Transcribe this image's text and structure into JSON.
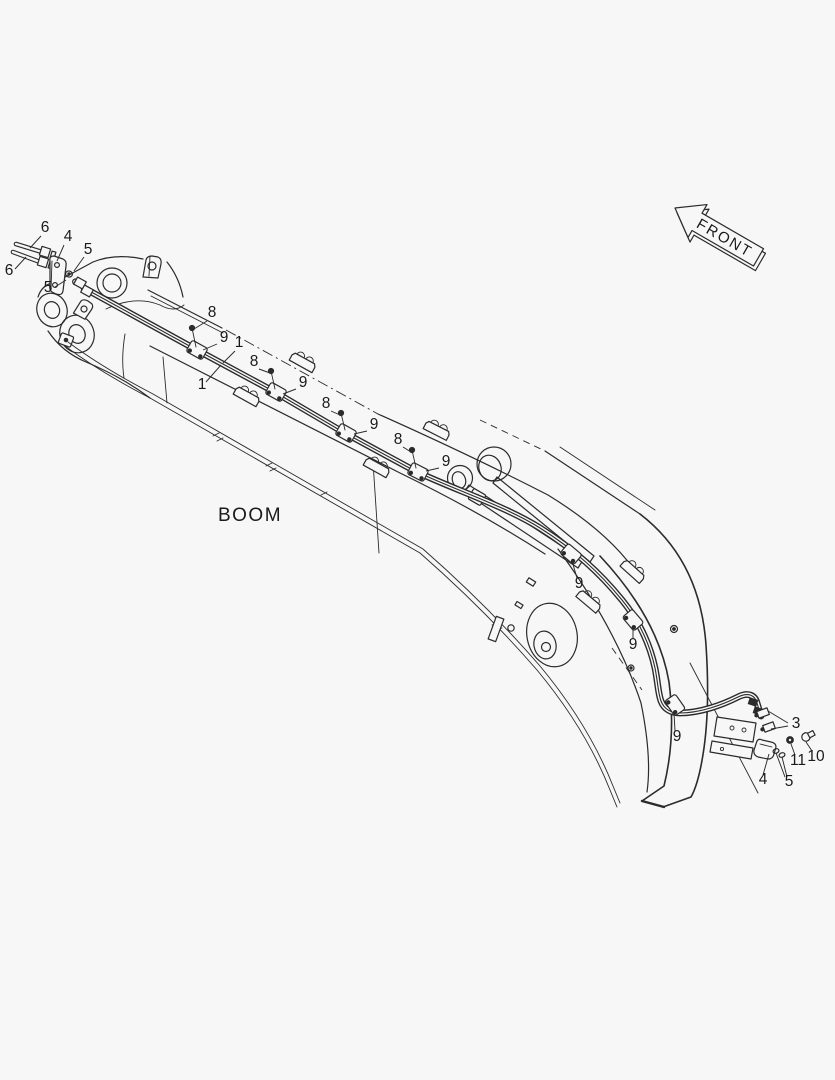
{
  "figure": {
    "type": "parts-diagram",
    "boom_label": "BOOM",
    "front_label": "FRONT"
  },
  "colors": {
    "background": "#f7f7f7",
    "line": "#2b2b2b",
    "text": "#1a1a1a"
  },
  "boom_label_pos": {
    "x": 250,
    "y": 521
  },
  "callouts": [
    {
      "t": "6",
      "x": 45,
      "y": 232,
      "l": [
        [
          41,
          236,
          30,
          248
        ]
      ]
    },
    {
      "t": "4",
      "x": 68,
      "y": 241,
      "l": [
        [
          64,
          245,
          57,
          261
        ]
      ]
    },
    {
      "t": "5",
      "x": 88,
      "y": 254,
      "l": [
        [
          84,
          257,
          74,
          271
        ]
      ]
    },
    {
      "t": "6",
      "x": 9,
      "y": 275,
      "l": [
        [
          15,
          269,
          26,
          257
        ]
      ]
    },
    {
      "t": "5",
      "x": 48,
      "y": 292,
      "l": [
        [
          55,
          287,
          66,
          280
        ]
      ]
    },
    {
      "t": "8",
      "x": 212,
      "y": 317,
      "l": [
        [
          207,
          321,
          194,
          329
        ]
      ]
    },
    {
      "t": "9",
      "x": 224,
      "y": 342,
      "l": [
        [
          217,
          344,
          203,
          350
        ]
      ]
    },
    {
      "t": "1",
      "x": 239,
      "y": 347,
      "l": [
        [
          235,
          351,
          223,
          363
        ]
      ]
    },
    {
      "t": "1",
      "x": 202,
      "y": 389,
      "l": [
        [
          206,
          382,
          221,
          365
        ]
      ]
    },
    {
      "t": "8",
      "x": 254,
      "y": 366,
      "l": [
        [
          259,
          369,
          270,
          373
        ]
      ]
    },
    {
      "t": "9",
      "x": 303,
      "y": 387,
      "l": [
        [
          296,
          389,
          283,
          394
        ]
      ]
    },
    {
      "t": "8",
      "x": 326,
      "y": 408,
      "l": [
        [
          331,
          411,
          340,
          415
        ]
      ]
    },
    {
      "t": "9",
      "x": 374,
      "y": 429,
      "l": [
        [
          367,
          431,
          354,
          434
        ]
      ]
    },
    {
      "t": "8",
      "x": 398,
      "y": 444,
      "l": [
        [
          403,
          447,
          411,
          452
        ]
      ]
    },
    {
      "t": "9",
      "x": 446,
      "y": 466,
      "l": [
        [
          439,
          468,
          426,
          471
        ]
      ]
    },
    {
      "t": "9",
      "x": 579,
      "y": 588,
      "l": [
        [
          577,
          578,
          572,
          561
        ]
      ]
    },
    {
      "t": "9",
      "x": 633,
      "y": 649,
      "l": [
        [
          633,
          639,
          633,
          626
        ]
      ]
    },
    {
      "t": "9",
      "x": 677,
      "y": 741,
      "l": [
        [
          675,
          731,
          674,
          713
        ]
      ]
    },
    {
      "t": "3",
      "x": 796,
      "y": 728,
      "l": [
        [
          788,
          723,
          768,
          711
        ],
        [
          788,
          726,
          771,
          729
        ]
      ]
    },
    {
      "t": "10",
      "x": 816,
      "y": 761,
      "l": [
        [
          812,
          751,
          806,
          742
        ]
      ]
    },
    {
      "t": "11",
      "x": 798,
      "y": 765,
      "l": [
        [
          795,
          755,
          791,
          744
        ]
      ]
    },
    {
      "t": "5",
      "x": 789,
      "y": 786,
      "l": [
        [
          785,
          777,
          776,
          753
        ],
        [
          787,
          777,
          782,
          757
        ]
      ]
    },
    {
      "t": "4",
      "x": 763,
      "y": 784,
      "l": [
        [
          763,
          775,
          769,
          754
        ]
      ]
    }
  ]
}
